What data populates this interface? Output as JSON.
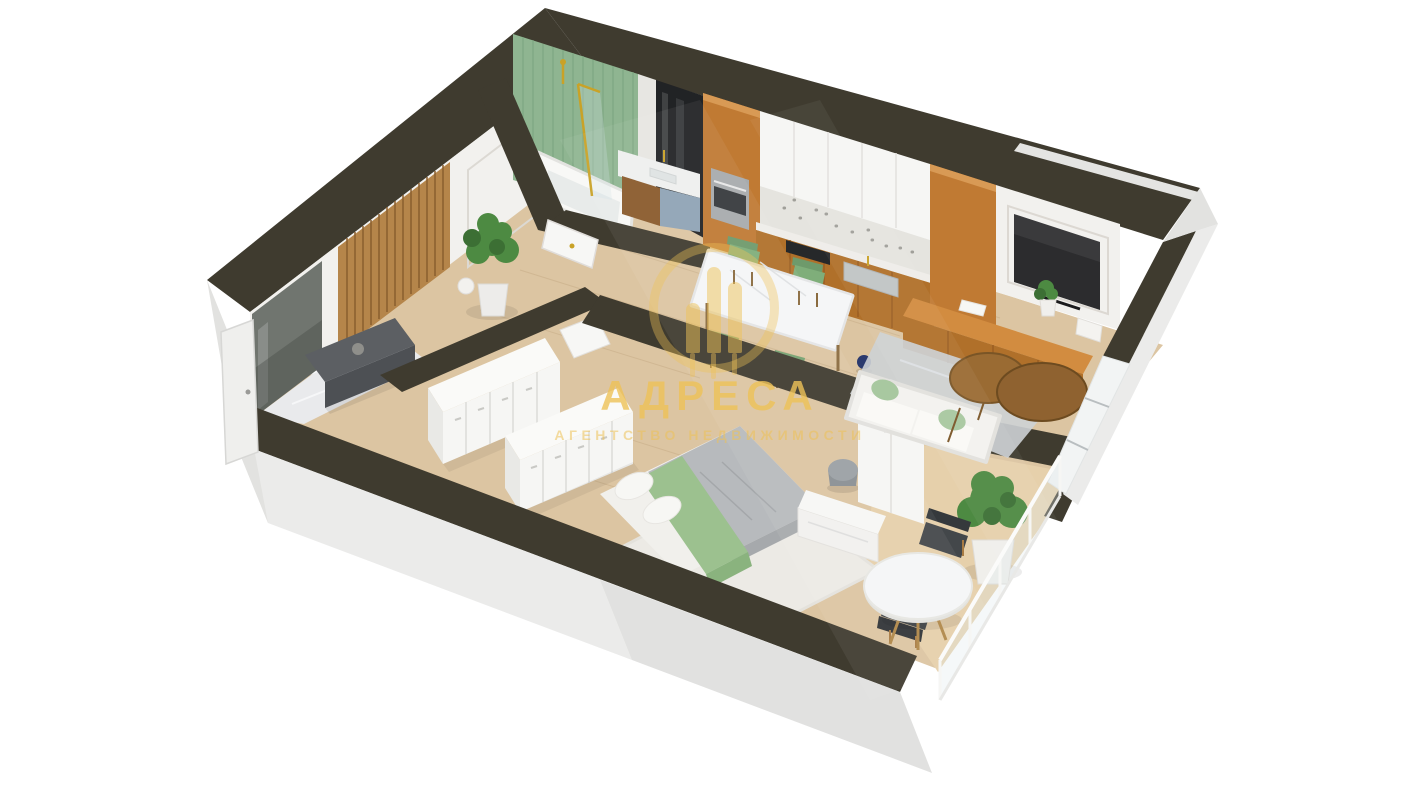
{
  "watermark": {
    "title": "АДРЕСА",
    "subtitle": "АГЕНТСТВО НЕДВИЖИМОСТИ",
    "logo_icon": "adresa-bars-logo-icon"
  },
  "scene": {
    "description": "3D isometric cutaway floor-plan render of a one-bedroom apartment on a white background",
    "rooms": [
      {
        "name": "hallway",
        "contents": [
          "entrance-door",
          "mirror",
          "wood-slat-panel",
          "wall-moldings",
          "bench",
          "stone-decor",
          "potted-plant",
          "white-vase",
          "marble-floor"
        ]
      },
      {
        "name": "bathroom",
        "contents": [
          "green-tile-wall",
          "marble-strip",
          "mirror-wall",
          "bathtub",
          "gold-glass-shower-screen",
          "shower-head",
          "vanity-with-sink",
          "gold-faucet",
          "door"
        ]
      },
      {
        "name": "kitchen",
        "contents": [
          "tall-cabinet-with-oven",
          "white-upper-cabinets",
          "terrazzo-backsplash",
          "countertop",
          "cooktop",
          "sink",
          "wood-base-cabinets",
          "tall-cabinet"
        ]
      },
      {
        "name": "dining-area",
        "contents": [
          "marble-dining-table",
          "green-chair",
          "green-chair",
          "green-chair",
          "green-chair",
          "blue-vase"
        ]
      },
      {
        "name": "living-area",
        "contents": [
          "tv-panel-wall",
          "tv",
          "wood-media-bench",
          "books",
          "small-plant",
          "white-decor-stack",
          "gray-rug",
          "sofa",
          "green-pillows",
          "round-coffee-table",
          "round-coffee-table",
          "window-band"
        ]
      },
      {
        "name": "wardrobe-room",
        "contents": [
          "open-closet-row",
          "open-closet-row",
          "interior-door"
        ]
      },
      {
        "name": "bedroom",
        "contents": [
          "double-bed",
          "gray-blanket",
          "green-throw",
          "pillows",
          "fluffy-rug",
          "vanity-desk",
          "round-stool",
          "wardrobe"
        ]
      },
      {
        "name": "balcony",
        "contents": [
          "round-table",
          "dark-chair",
          "dark-chair",
          "large-potted-plant",
          "glass-railing"
        ]
      }
    ]
  },
  "colors": {
    "background": "#ffffff",
    "wall_top": "#3f3b2f",
    "wall_face": "#ebebea",
    "wall_face_shade": "#e2e2e0",
    "wall_inner": "#f2f1ee",
    "floor_wood": "#dcc5a2",
    "floor_wood_light": "#e6d0ab",
    "marble_floor": "#e9eaec",
    "tile_green": "#8fb591",
    "mirror_dark": "#212325",
    "gold": "#c9a227",
    "cabinet_wood": "#c07a33",
    "cabinet_wood_dark": "#b0702a",
    "cabinet_white": "#f6f6f4",
    "backsplash": "#e5e4df",
    "bench_wood": "#d28c40",
    "tv_black": "#2c2c2e",
    "chair_green": "#7fae7a",
    "sofa_white": "#f3f2ef",
    "pillow_green": "#a8c8a0",
    "rug_gray": "#cdd1d5",
    "rug_white": "#eceae5",
    "bed_gray": "#b7babd",
    "bed_green": "#9cc18f",
    "table_white": "#f5f6f7",
    "coffee_wood": "#9a6b33",
    "plant_green": "#4d8a42",
    "plant_green_dark": "#3c6f34",
    "hall_bench_gray": "#5c5f63",
    "slat_wood": "#b5854a",
    "balcony_chair_dark": "#43474a",
    "blue_vase": "#2b3a6e",
    "watermark_yellow": "#eec258"
  }
}
